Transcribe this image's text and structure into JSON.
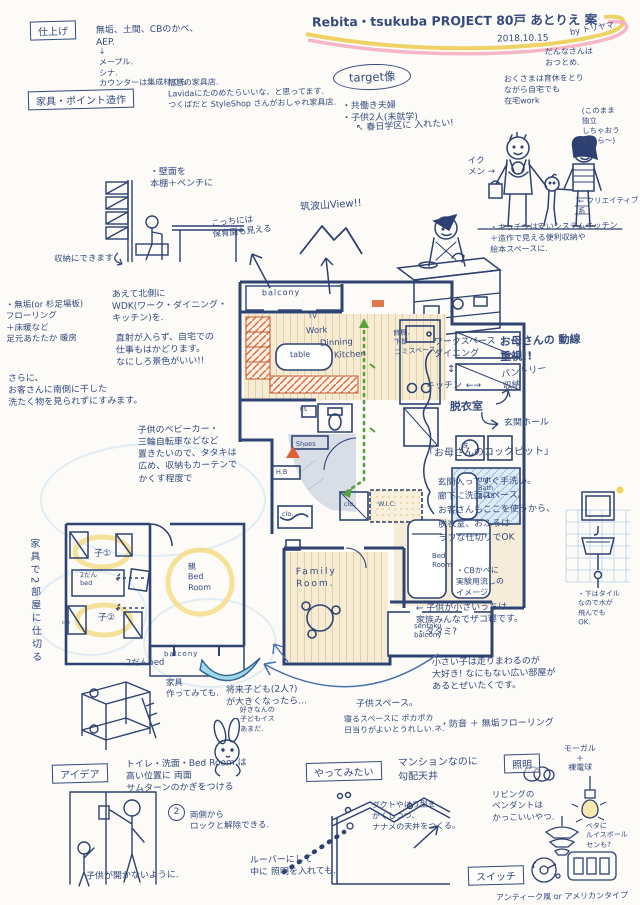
{
  "title": {
    "main": "Rebita・tsukuba PROJECT 80戸 あとりえ 案",
    "date": "2018.10.15",
    "author": "by トリヤマ"
  },
  "finish": {
    "label": "仕上げ",
    "materials": "無垢、土間、CBのかべ、\nAEP.",
    "detail": "↓\nメープル.\nシナ.\nカウンターは集成材でも"
  },
  "furniture": {
    "label": "家具・ポイント造作",
    "note": "福島の家具店.\nLavidaにたのめたらいいな、と思ってます.\nつくばだと StyleShop さんがおしゃれ家具店."
  },
  "target": {
    "label": "target像",
    "items": "・共働き夫婦\n・子供2人(未就学)",
    "husband": "だんなさんは\nおつとめ.",
    "wife": "おくさまは育休をとり\nながら自宅でも\n在宅work",
    "solo": "(このまま\n独立\nしちゃおう\nかしら〜)",
    "school": "↖ 春日学区に 入れたい!",
    "ikumen": "イク\nメン →",
    "creative": "← クリエイティブ\n系"
  },
  "kitchen_note": "・キッチンは安いシステムキッチン\n＋造作で見える便利収納や\n絵本スペースに.",
  "view": {
    "mt": "筑波山View!!",
    "nursery": "こっちには\n保育園も見える"
  },
  "bench": {
    "title": "・壁面を\n本棚＋ベンチに",
    "note": "収納にできます."
  },
  "north": {
    "flooring": "・無垢(or 杉足場板)\nフローリング\n＋床暖など\n足元あたたか 暖房",
    "wdk": "あえて北側に\nWDK(ワーク・ダイニング・\nキッチン)を.",
    "work": "直射が入らず、自宅での\n仕事もはかどります。\nなにしろ景色がいい!!",
    "laundry": "さらに、\nお客さんに南側に干した\n洗たく物を見られずにすみます。"
  },
  "entry_note": "子供のベビーカー・\n三輪自転車などなど\n置きたいので、タタキは\n広め、収納もカーテンで\nかくす程度で",
  "plan": {
    "balcony": "balcony",
    "tv": "TV",
    "work": "Work",
    "dinning": "Dinning",
    "kitchen": "Kitchen",
    "table": "table",
    "shoes": "Shoes",
    "hb": "H.B",
    "clo_entry": "clo.",
    "ps": "PS",
    "wash": "洗",
    "unit_bath": "Unit\nBath\n1418",
    "clo": "clo.",
    "wic": "W.I.C.",
    "family": "Family\nRoom.",
    "bed": "Bed\nRoom",
    "sentaku": "sentaku\nbalcony"
  },
  "shelf_note": "飾棚.\n下部\nゴミスペース",
  "flow": {
    "heavy": "お母さんの 動線\n重視!!",
    "ws": "ワークスペース\nダイニング",
    "ud": "↕",
    "kitchen": "キッチン",
    "lr": "←→",
    "pantry": "パントリー\n収納",
    "datsui": "脱衣室",
    "genkan": "玄関ホール",
    "cockpit": "「お母さんのコックピット」"
  },
  "mother": "玄関入ってすぐ手洗い。\n廊下に洗面スペース。\nお客さんもここを使うから、\n脱衣室、おふろは\nラフな仕切りでOK",
  "cb": "・CBかべに\n実験用流しの\nイメージ",
  "tile": "・下はタイル\nなので水が\n飛んでも\nOK.",
  "zakone": "← 子供が小さいうちは、\n家族みんなでザコ寝です。\n・タタミ?",
  "running": "小さい子は走りまわるのが\n大好き! なにもない広い部屋が\nあるとぜいたくです。",
  "soundproof": "・防音 ＋ 無垢フローリング",
  "left_plan": {
    "divider": "家具で2部屋に仕切る",
    "c1": "子①",
    "c2": "子②",
    "bunk": "2だん\nbed",
    "parent": "親\nBed\nRoom",
    "balcony": "balcony",
    "clo": "clo"
  },
  "bunk": {
    "label": "2だんbed",
    "note": "家具\n作ってみても."
  },
  "future": "将来子ども(2人?)\nが大きくなったら…",
  "kids": {
    "space": "子供スペース。",
    "sun": "寝るスペースに ポカポカ\n日当りがよいとうれしい.ネ."
  },
  "chair": "好きなんの\n子どもイス\nあまだ.",
  "idea": {
    "label": "アイデア",
    "lock": "トイレ・洗面・Bed Room は\n高い位置に 両面\nサムターンのかぎをつける",
    "num": "2",
    "both": "両側から\nロックと解除できる.",
    "child": "子供が開かないように."
  },
  "try": {
    "label": "やってみたい",
    "slope": "マンションなのに\n勾配天井",
    "duct": "ダクトやはり型を\nかくしつつ、\nナナメの天井をつくる。",
    "louver": "ルーバーにして\n中に 照明を入れても."
  },
  "light": {
    "label": "照明",
    "mogal": "モーガル\n＋\n裸電球",
    "living": "リビングの\nペンダントは\nかっこいいやつ.",
    "louis": "ベタに\nルイスポール\nセンも?"
  },
  "sw": {
    "label": "スイッチ",
    "types": "アンティーク風 or アメリカンタイプ"
  },
  "colors": {
    "ink": "#35497d",
    "marker_yellow": "#ecca4c",
    "marker_pink": "#f3aabd",
    "shelf_orange": "#e0784a",
    "route_green": "#58a23c",
    "bath_blue": "#a9c8e2"
  }
}
